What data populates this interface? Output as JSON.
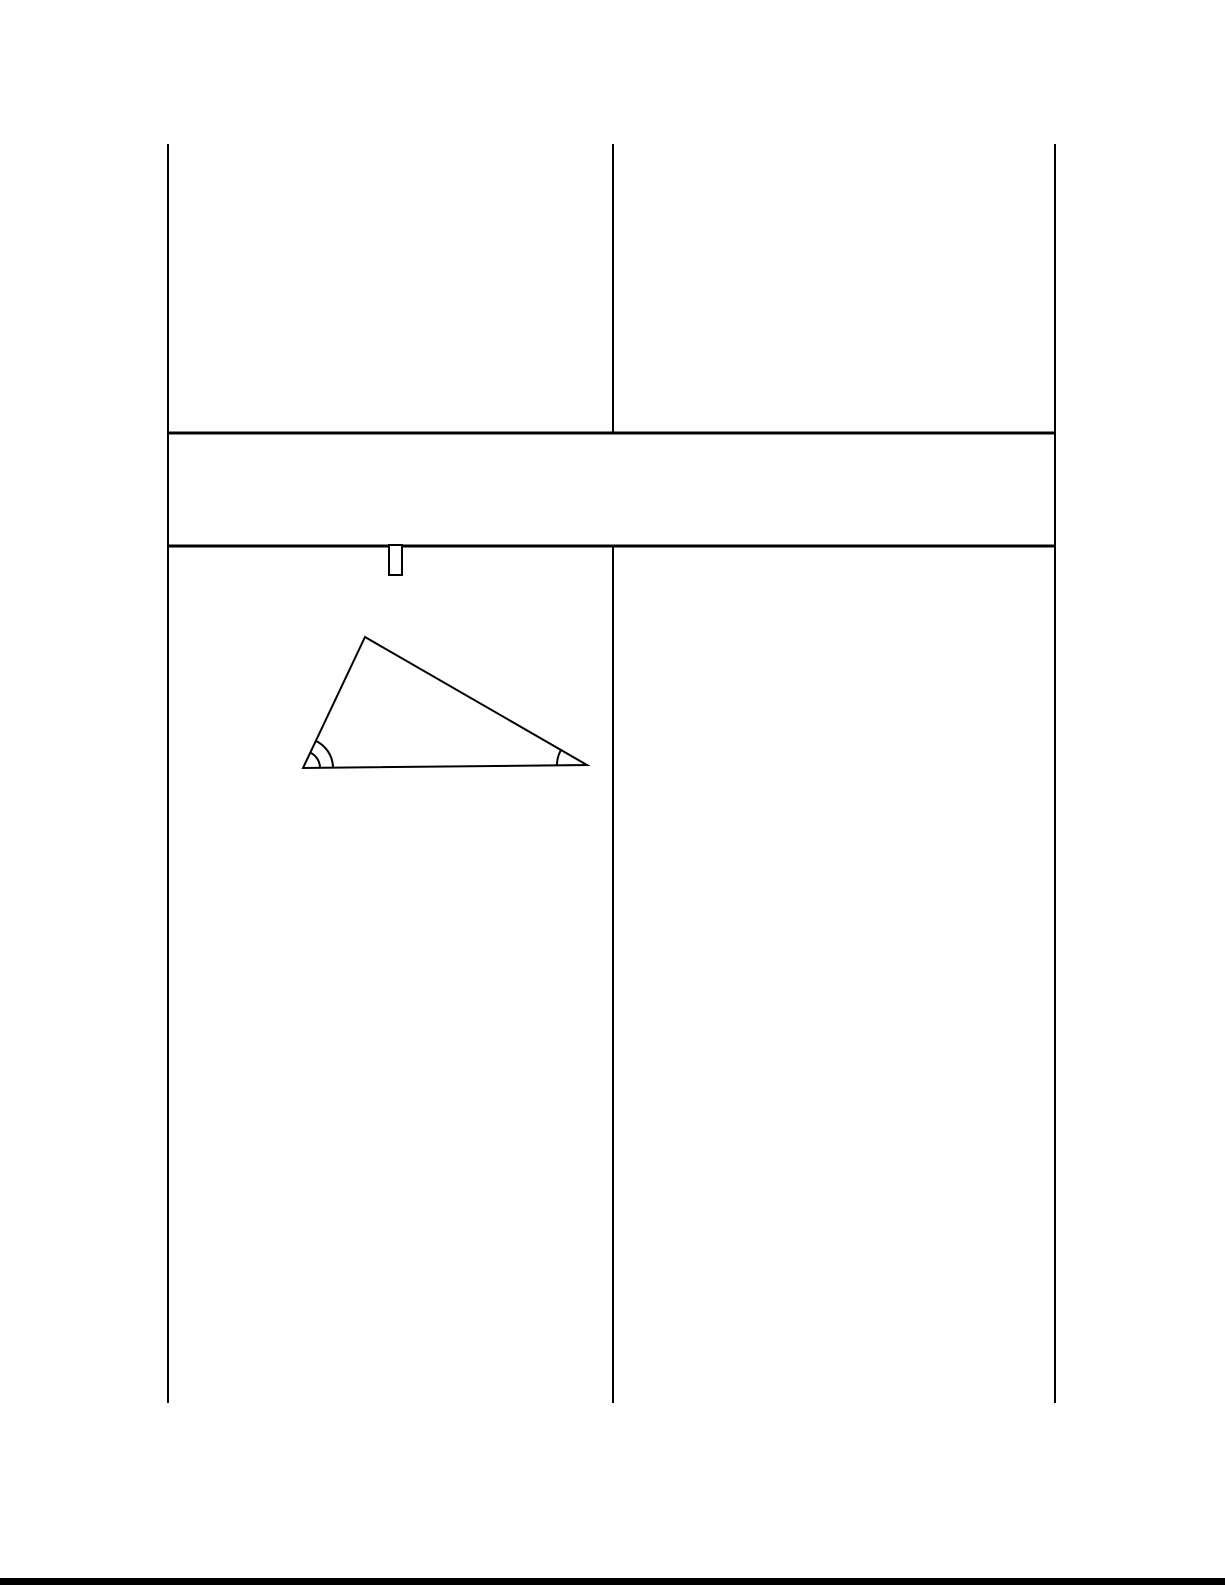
{
  "page": {
    "width": 1225,
    "height": 1585,
    "background": "#ffffff",
    "line_color": "#000000"
  },
  "table": {
    "border_color": "#000000",
    "lines": [
      {
        "name": "border-left",
        "x1": 168,
        "y1": 144,
        "x2": 168,
        "y2": 1403,
        "w": 2
      },
      {
        "name": "divider-middle-upper",
        "x1": 613,
        "y1": 144,
        "x2": 613,
        "y2": 433,
        "w": 2
      },
      {
        "name": "divider-middle-lower",
        "x1": 613,
        "y1": 546,
        "x2": 613,
        "y2": 1403,
        "w": 2
      },
      {
        "name": "border-right",
        "x1": 1055,
        "y1": 144,
        "x2": 1055,
        "y2": 1403,
        "w": 2
      },
      {
        "name": "row-divider-top",
        "x1": 168,
        "y1": 433,
        "x2": 1055,
        "y2": 433,
        "w": 3
      },
      {
        "name": "row-divider-bottom",
        "x1": 168,
        "y1": 546,
        "x2": 1055,
        "y2": 546,
        "w": 3
      }
    ]
  },
  "glyph_box": {
    "x": 389,
    "y": 545,
    "width": 13,
    "height": 30,
    "stroke_width": 2,
    "fill": "#ffffff"
  },
  "figure": {
    "type": "triangle",
    "stroke_color": "#000000",
    "stroke_width": 2,
    "vertices": {
      "A": [
        303,
        768
      ],
      "B": [
        365,
        637
      ],
      "C": [
        587,
        765
      ]
    },
    "angle_marks": [
      {
        "at": "A",
        "from": "C",
        "to": "B",
        "sweep": 0,
        "radii": [
          17,
          30
        ]
      },
      {
        "at": "C",
        "from": "A",
        "to": "B",
        "sweep": 1,
        "radii": [
          30
        ]
      }
    ]
  },
  "footer_bar": {
    "y": 1578,
    "height": 7,
    "color": "#000000"
  }
}
